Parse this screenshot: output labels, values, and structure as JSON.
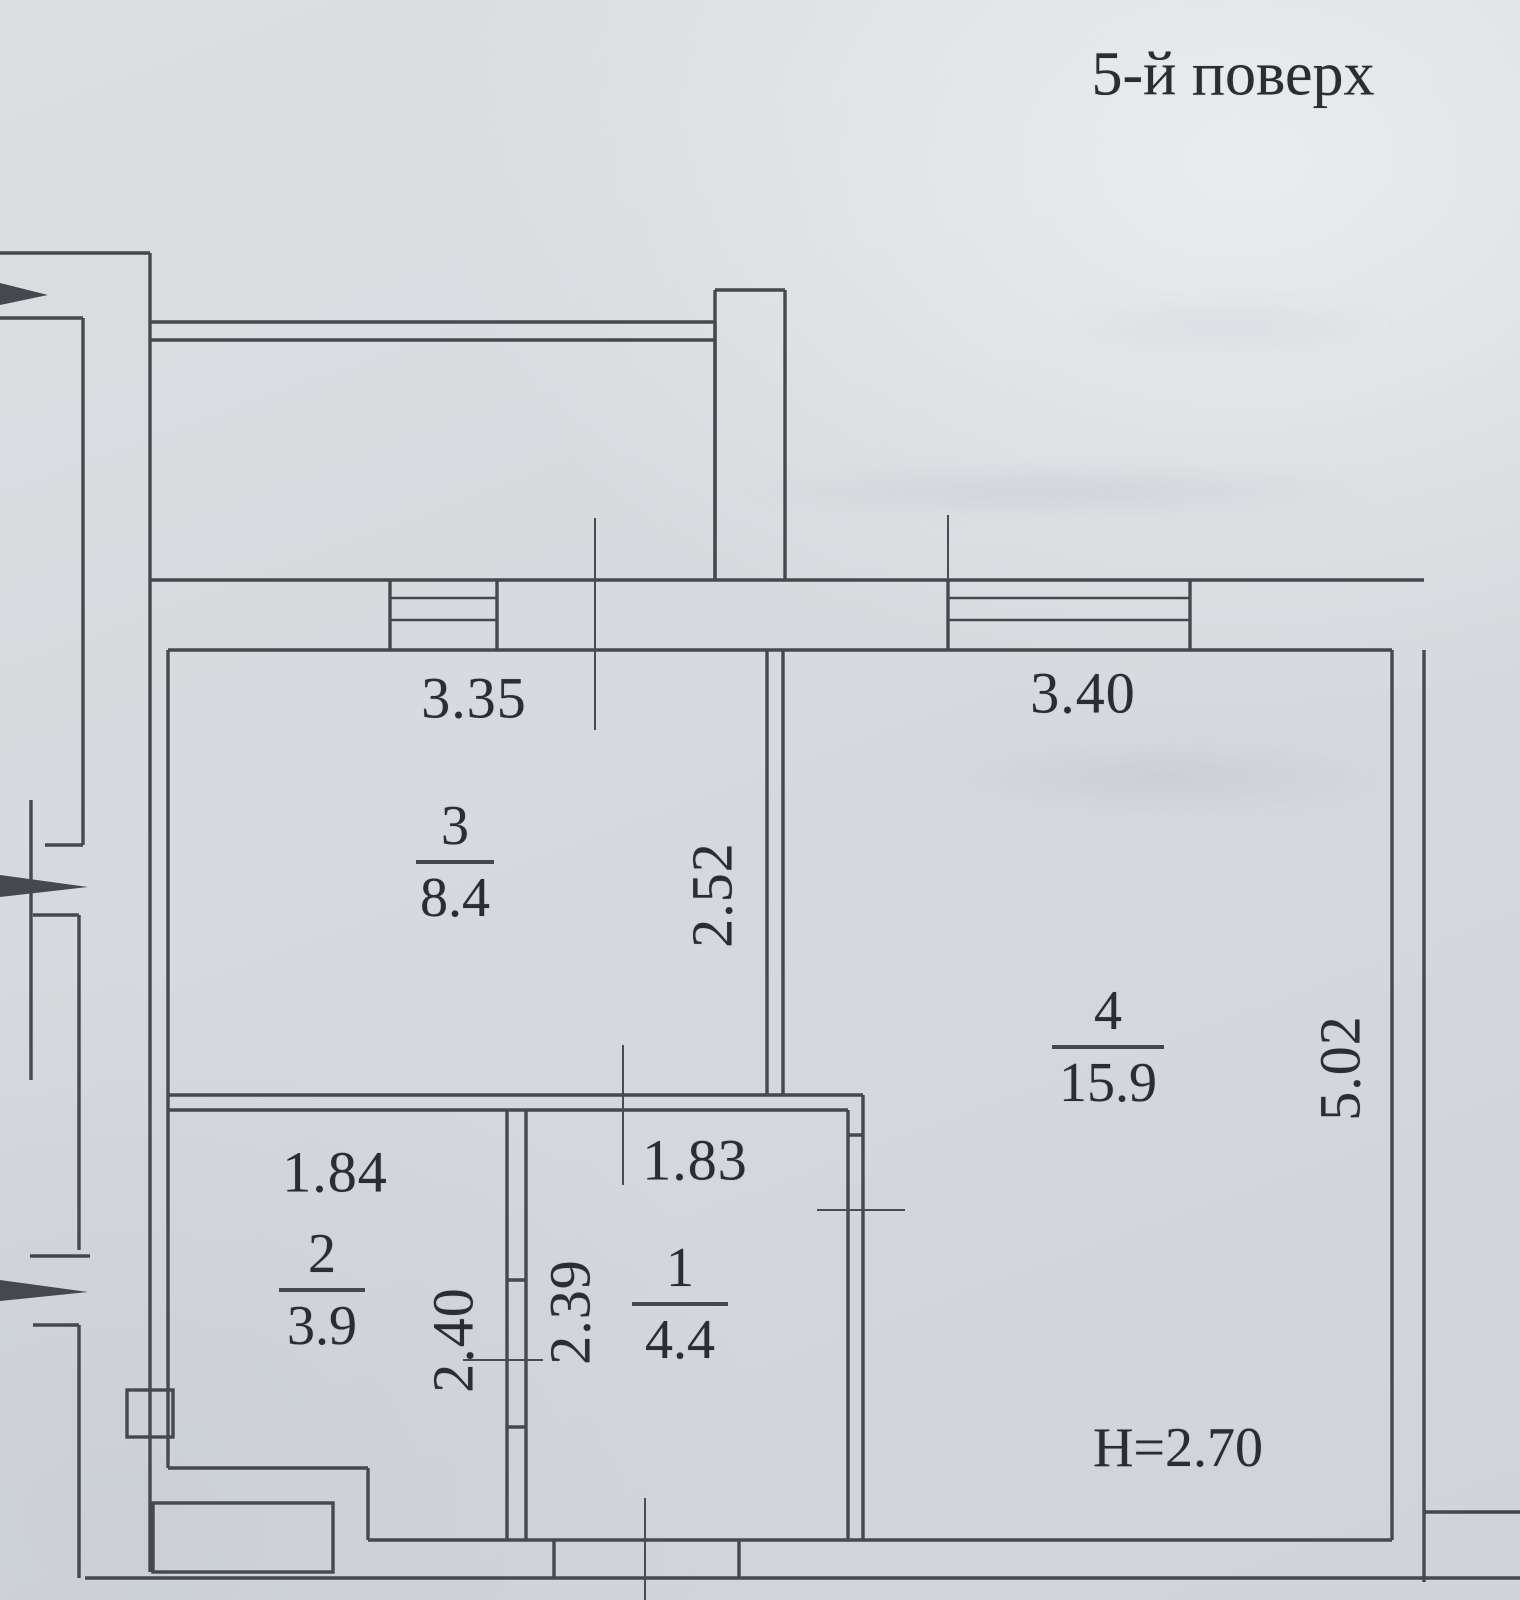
{
  "title": "5-й поверх",
  "plan": {
    "rooms": [
      {
        "number": "1",
        "area": "4.4",
        "width": "1.83",
        "depth": "2.39"
      },
      {
        "number": "2",
        "area": "3.9",
        "width": "1.84",
        "depth": "2.40"
      },
      {
        "number": "3",
        "area": "8.4",
        "width": "3.35",
        "depth": "2.52"
      },
      {
        "number": "4",
        "area": "15.9",
        "width": "3.40",
        "depth": "5.02",
        "ceiling_height": "H=2.70"
      }
    ]
  },
  "colors": {
    "paper": "#d6d9dd",
    "ink": "#46484d",
    "text": "#2b2d32"
  }
}
